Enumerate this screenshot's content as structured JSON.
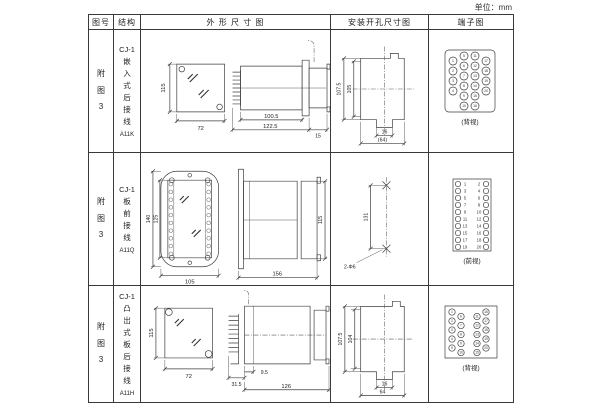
{
  "page": {
    "unit": "单位：mm"
  },
  "headers": {
    "fig": "图号",
    "structure": "结构",
    "outline": "外 形 尺 寸 图",
    "mounting": "安装开孔尺寸图",
    "terminal": "端子图"
  },
  "rows": [
    {
      "fig": "附图3",
      "model": "CJ-1",
      "mount_type": "嵌入式后接线",
      "code": "A11K",
      "dims": {
        "h": "115",
        "w": "72",
        "body": "100.5",
        "total": "122.5",
        "rear": "15"
      },
      "mounting": {
        "outer": "107.5",
        "inner": "105",
        "slot": "16",
        "width": "(64)"
      },
      "terminal": {
        "view": "(背视)",
        "col_a": [
          "1",
          "2",
          "3",
          "4"
        ],
        "col_b": [
          "5",
          "6",
          "7",
          "8",
          "9",
          "10"
        ],
        "col_c": [
          "11",
          "12",
          "13",
          "14",
          "15",
          "16"
        ],
        "col_d": [
          "17",
          "18",
          "19",
          "20"
        ]
      }
    },
    {
      "fig": "附图3",
      "model": "CJ-1",
      "mount_type": "板前接线",
      "code": "A11Q",
      "dims": {
        "outer_h": "140",
        "inner_h": "125",
        "w": "105",
        "len": "156",
        "h": "115"
      },
      "mounting": {
        "pitch": "131",
        "holes": "2-Φ6"
      },
      "terminal": {
        "view": "(前视)",
        "left": [
          "1",
          "3",
          "5",
          "7",
          "9",
          "11",
          "13",
          "15",
          "17",
          "19"
        ],
        "right": [
          "2",
          "4",
          "6",
          "8",
          "10",
          "12",
          "14",
          "16",
          "18",
          "20"
        ]
      }
    },
    {
      "fig": "附图3",
      "model": "CJ-1",
      "mount_type": "凸出式板后接线",
      "code": "A11H",
      "dims": {
        "h": "115",
        "w": "72",
        "pins": "31.5",
        "step": "9.5",
        "len": "126"
      },
      "mounting": {
        "outer": "107.5",
        "inner": "104",
        "slot": "16",
        "width": "64"
      },
      "terminal": {
        "view": "(背视)",
        "col_a": [
          "1",
          "2",
          "3",
          "4",
          "5"
        ],
        "col_b": [
          "6",
          "7",
          "8",
          "9",
          "10"
        ],
        "col_c": [
          "11",
          "12",
          "13",
          "14",
          "15"
        ],
        "col_d": [
          "16",
          "17",
          "18",
          "19",
          "20"
        ]
      }
    }
  ]
}
